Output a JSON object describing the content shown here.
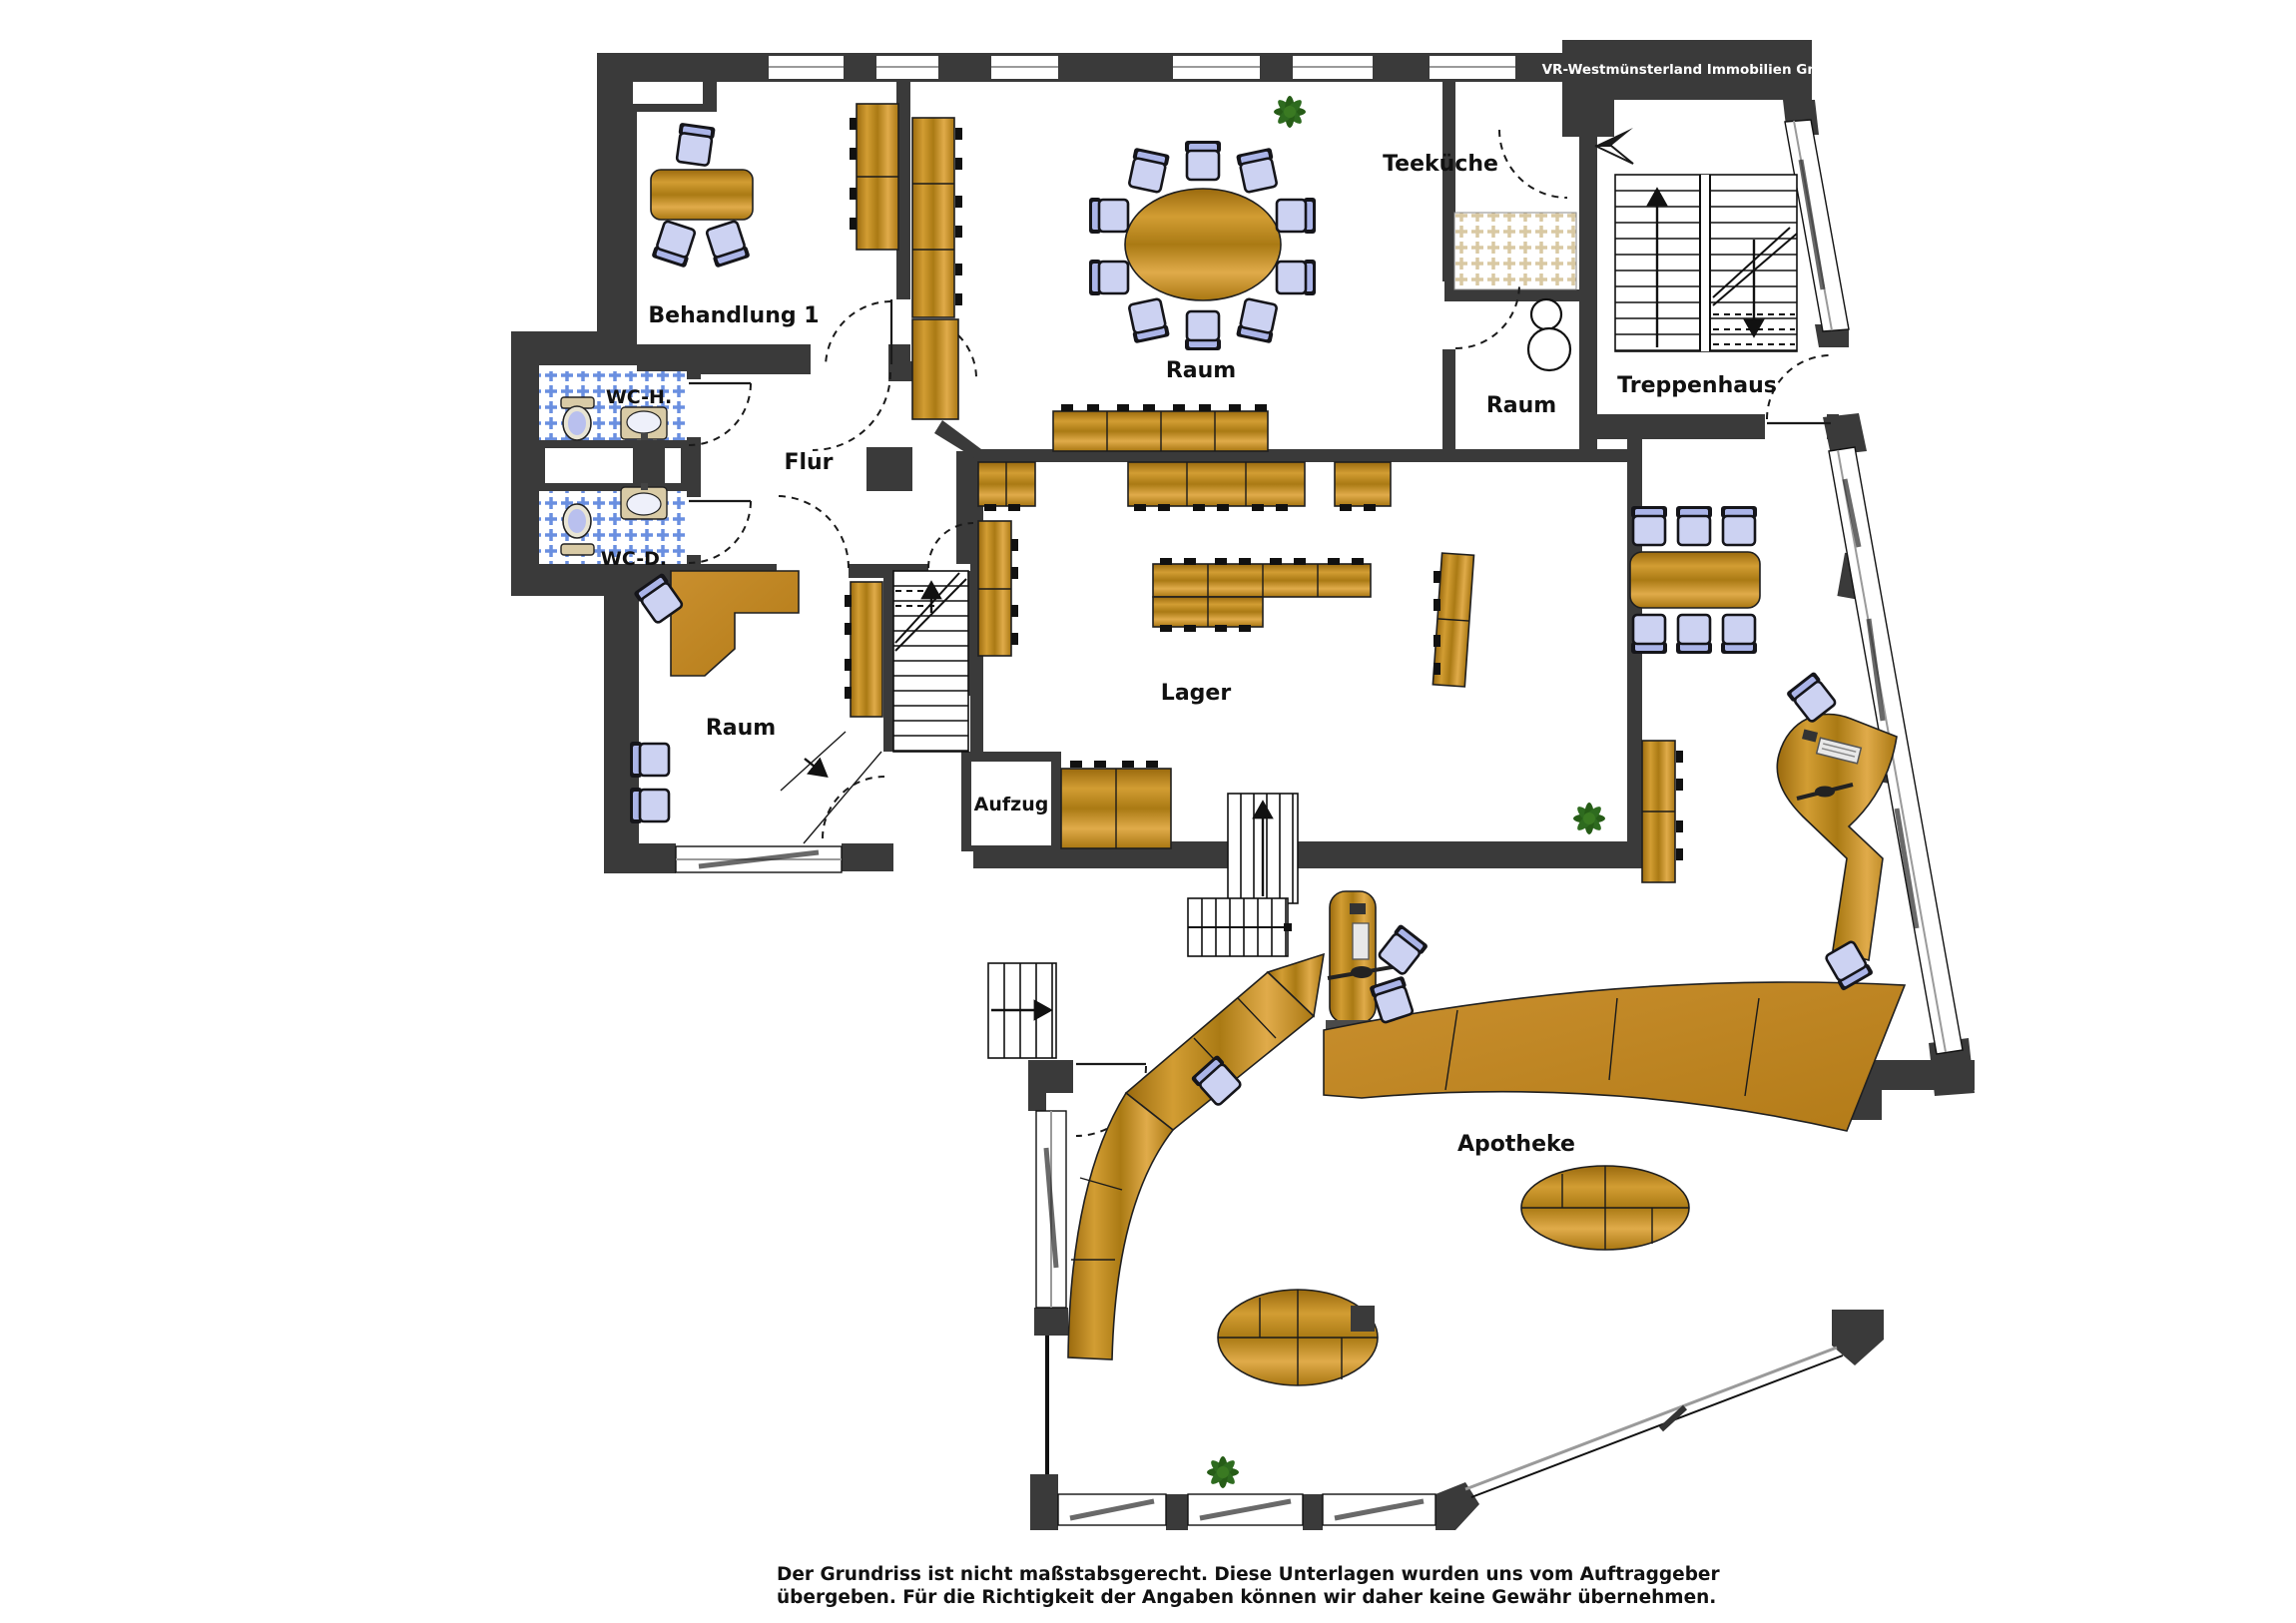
{
  "branding": {
    "company": "VR-Westmünsterland Immobilien GmbH"
  },
  "rooms": {
    "behandlung1": "Behandlung 1",
    "wc_h": "WC-H.",
    "wc_d": "WC-D.",
    "flur": "Flur",
    "raum_top": "Raum",
    "teekueche": "Teeküche",
    "raum_right": "Raum",
    "treppenhaus": "Treppenhaus",
    "lager": "Lager",
    "raum_left": "Raum",
    "aufzug": "Aufzug",
    "apotheke": "Apotheke"
  },
  "footer": {
    "line1": "Der Grundriss ist nicht maßstabsgerecht. Diese Unterlagen wurden uns vom Auftraggeber",
    "line2": "übergeben. Für die Richtigkeit der Angaben können wir daher keine Gewähr übernehmen."
  },
  "colors": {
    "wall": "#3a3a3a",
    "wood": "#c6892b",
    "wood_dark": "#8a5c10",
    "chair": "#ccd2f2",
    "tile_blue": "#6a8fe0",
    "tile_beige": "#d9c9a3",
    "plant_green": "#2e6b1f",
    "glazing": "#9a9a9a",
    "background": "#ffffff",
    "text": "#111111"
  }
}
